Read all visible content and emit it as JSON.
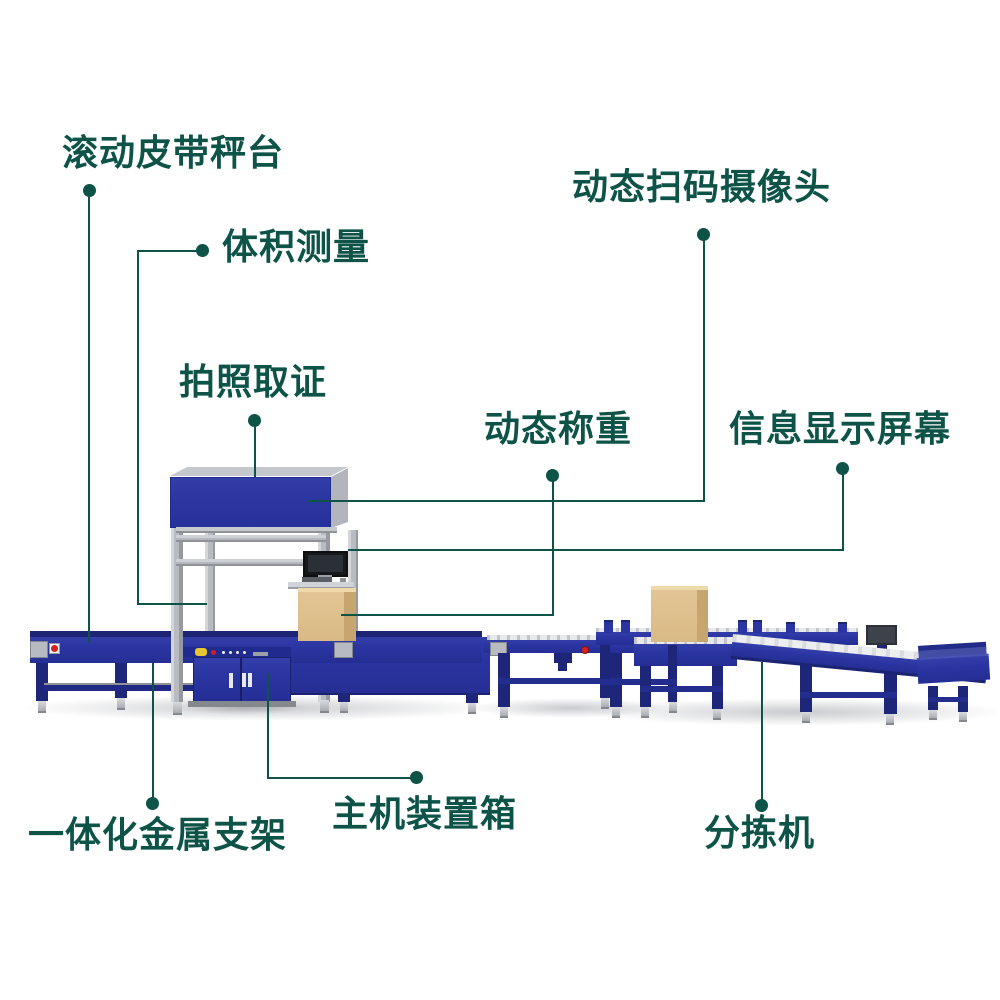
{
  "figure": {
    "type": "labeled-equipment-diagram",
    "subject": "DWS parcel weighing / scanning / sorting line",
    "background": "#ffffff"
  },
  "colors": {
    "label_text": "#0d5348",
    "leader_line": "#0d5348",
    "machine_blue": "#2a35a2",
    "machine_blue_dark": "#1d2678",
    "metal_gray": "#bcbfc5",
    "roller_belt_gray": "#e9ebee",
    "cardboard_box": "#dcbd8b",
    "emergency_red": "#d42020",
    "button_yellow": "#e8c62f",
    "monitor_black": "#17181b"
  },
  "labels": [
    {
      "id": "rolling-belt-scale",
      "text": "滚动皮带秤台"
    },
    {
      "id": "volume-measurement",
      "text": "体积测量"
    },
    {
      "id": "photo-capture",
      "text": "拍照取证"
    },
    {
      "id": "dynamic-scan-camera",
      "text": "动态扫码摄像头"
    },
    {
      "id": "dynamic-weighing",
      "text": "动态称重"
    },
    {
      "id": "info-display-screen",
      "text": "信息显示屏幕"
    },
    {
      "id": "integrated-metal-frame",
      "text": "一体化金属支架"
    },
    {
      "id": "main-unit-cabinet",
      "text": "主机装置箱"
    },
    {
      "id": "sorter",
      "text": "分拣机"
    }
  ],
  "machine_parts": [
    "belt-scale-conveyor",
    "weighing-section",
    "gantry-frame",
    "camera-housing",
    "info-monitor",
    "keyboard-tray",
    "host-cabinet",
    "roller-conveyor",
    "sorter-table",
    "discharge-conveyor",
    "end-tray",
    "parcel-box",
    "emergency-stop-button",
    "control-plate",
    "sorter-display"
  ]
}
